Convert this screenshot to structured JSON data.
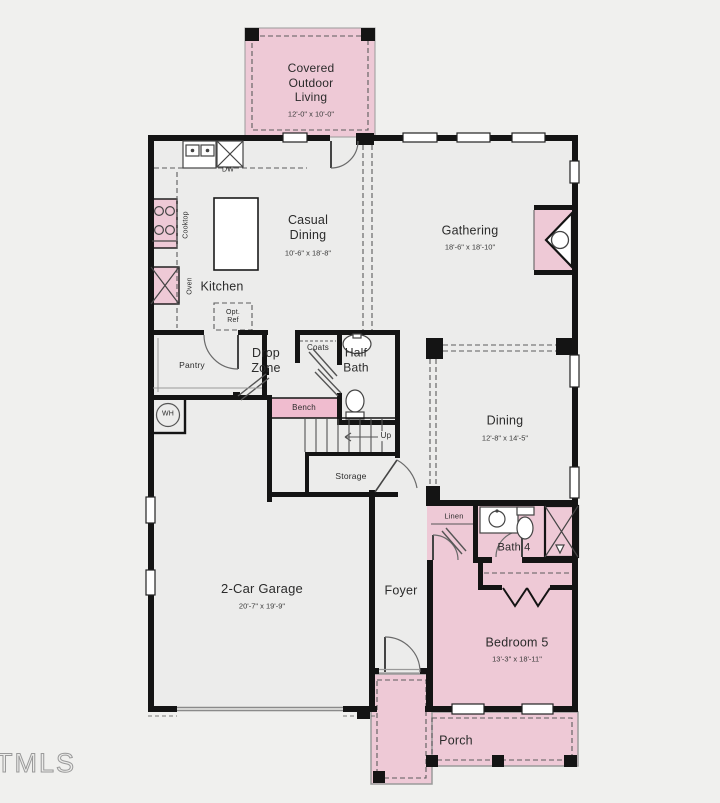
{
  "watermark": "TMLS",
  "colors": {
    "pink": "#eec9d6",
    "bench_pink": "#f0bccf",
    "wall": "#141414",
    "background": "#f0f0ee",
    "interior": "#ececeb"
  },
  "rooms": {
    "covered_outdoor_living": {
      "name": "Covered\nOutdoor\nLiving",
      "dims": "12'-0\" x 10'-0\""
    },
    "casual_dining": {
      "name": "Casual\nDining",
      "dims": "10'-6\" x 18'-8\""
    },
    "gathering": {
      "name": "Gathering",
      "dims": "18'-6\" x 18'-10\""
    },
    "kitchen": {
      "name": "Kitchen"
    },
    "pantry": {
      "name": "Pantry"
    },
    "drop_zone": {
      "name": "Drop\nZone"
    },
    "half_bath": {
      "name": "Half\nBath"
    },
    "dining": {
      "name": "Dining",
      "dims": "12'-8\" x 14'-5\""
    },
    "garage": {
      "name": "2-Car Garage",
      "dims": "20'-7\" x 19'-9\""
    },
    "foyer": {
      "name": "Foyer"
    },
    "bath4": {
      "name": "Bath 4"
    },
    "bedroom5": {
      "name": "Bedroom 5",
      "dims": "13'-3\" x 18'-11\""
    },
    "porch": {
      "name": "Porch"
    }
  },
  "fixtures": {
    "dw": "DW",
    "cooktop": "Cooktop",
    "oven": "Oven",
    "opt_ref": "Opt.\nRef",
    "coats": "Coats",
    "bench": "Bench",
    "wh": "WH",
    "linen": "Linen",
    "storage": "Storage",
    "up": "Up"
  }
}
